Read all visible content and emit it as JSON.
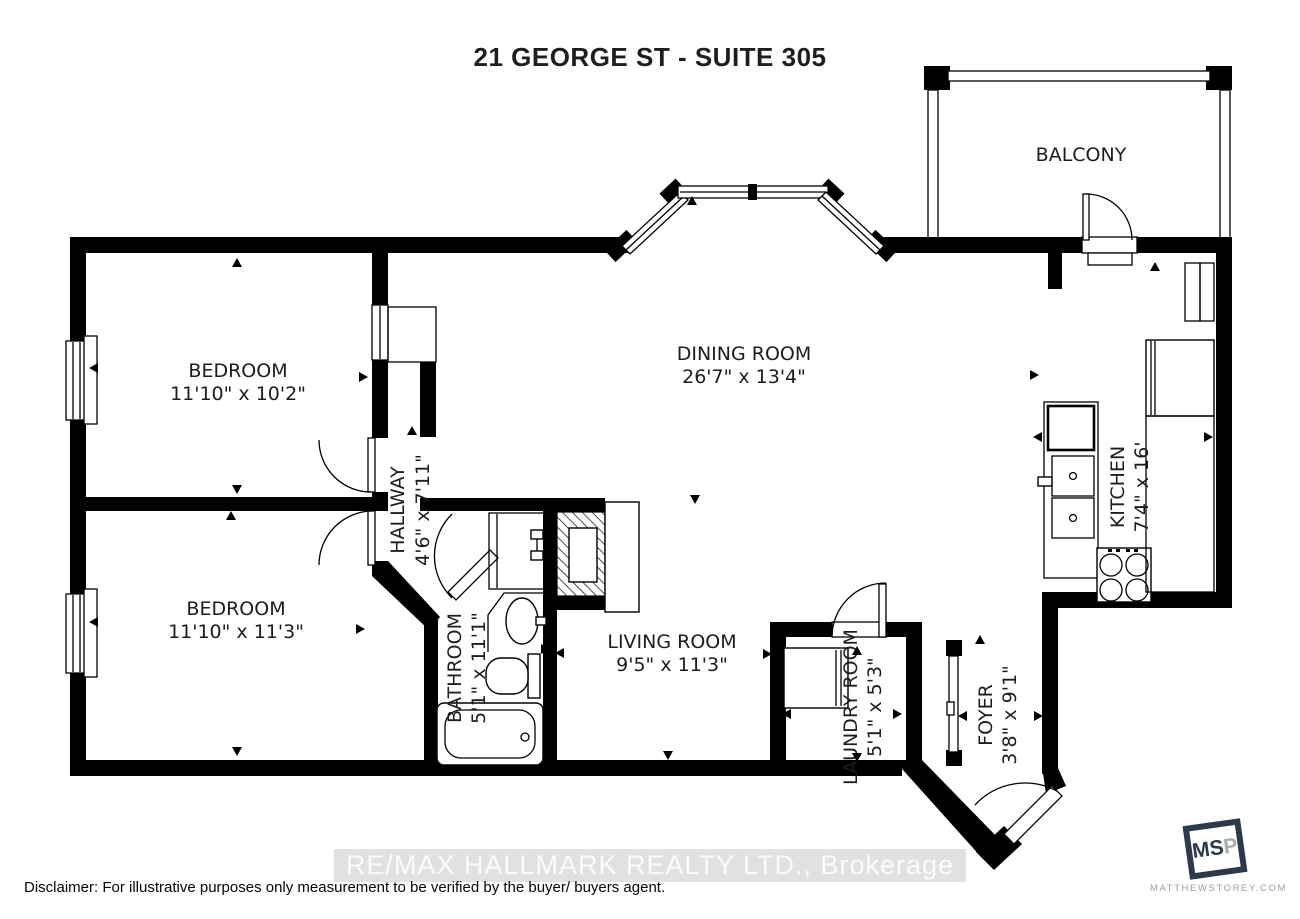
{
  "title": "21 GEORGE ST - SUITE 305",
  "rooms": {
    "balcony": {
      "name": "BALCONY"
    },
    "dining": {
      "name": "DINING ROOM",
      "dims": "26'7\" x 13'4\""
    },
    "bedroom1": {
      "name": "BEDROOM",
      "dims": "11'10\" x 10'2\""
    },
    "bedroom2": {
      "name": "BEDROOM",
      "dims": "11'10\" x 11'3\""
    },
    "hallway": {
      "name": "HALLWAY",
      "dims": "4'6\" x 7'11\""
    },
    "bathroom": {
      "name": "BATHROOM",
      "dims": "5'1\" x 11'1\""
    },
    "living": {
      "name": "LIVING ROOM",
      "dims": "9'5\" x 11'3\""
    },
    "laundry": {
      "name": "LAUNDRY ROOM",
      "dims": "5'1\" x 5'3\""
    },
    "foyer": {
      "name": "FOYER",
      "dims": "3'8\" x 9'1\""
    },
    "kitchen": {
      "name": "KITCHEN",
      "dims": "7'4\" x 16'"
    }
  },
  "watermark": "RE/MAX HALLMARK REALTY LTD., Brokerage",
  "disclaimer": "Disclaimer:  For illustrative purposes only measurement to be verified by the buyer/ buyers agent.",
  "logo": {
    "text_dark": "MS",
    "text_light": "P",
    "site": "MATTHEWSTOREY.COM"
  },
  "colors": {
    "wall": "#000000",
    "background": "#ffffff",
    "logo_navy": "#2c3b4c",
    "logo_gray": "#9aa0a6"
  }
}
